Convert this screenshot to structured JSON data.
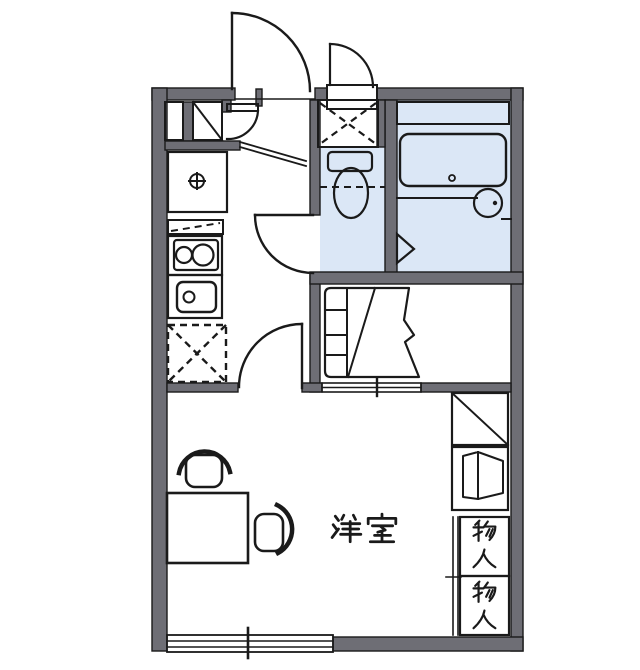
{
  "floorplan": {
    "room_label": "洋室",
    "storage_upper_label": "物入",
    "storage_lower_label": "物入",
    "colors": {
      "wall": "#6e6e75",
      "fixture_blue": "#dbe7f6",
      "storage_beige": "#f6e9ce",
      "line": "#1a1a1a",
      "background": "#ffffff"
    },
    "fixtures": [
      "entrance-door",
      "shoe-cabinet",
      "entrance-step",
      "washing-machine-space",
      "toilet",
      "bathtub",
      "washbasin",
      "bath-folding-door",
      "kitchen-faucet-unit",
      "gas-stove",
      "kitchen-sink",
      "refrigerator-space",
      "staircase",
      "sliding-window",
      "desk",
      "chair",
      "storage-closet"
    ]
  }
}
